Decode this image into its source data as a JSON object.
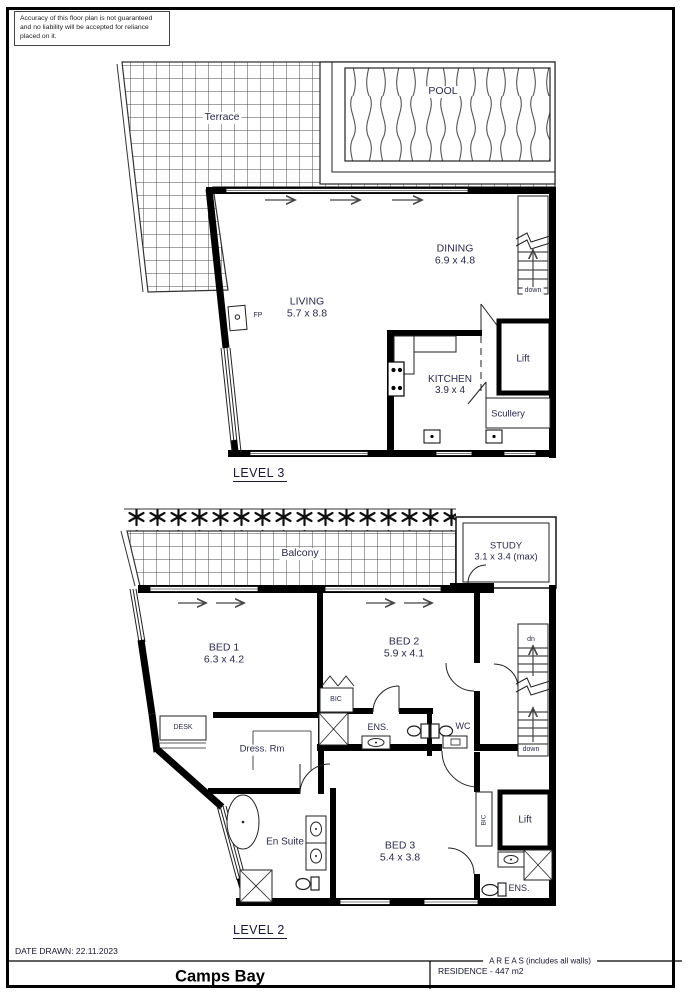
{
  "disclaimer": "Accuracy of this floor plan is not guaranteed and no liability will be accepted for reliance placed on it.",
  "l3": {
    "title": "LEVEL 3",
    "terrace": "Terrace",
    "pool": "POOL",
    "living": {
      "name": "LIVING",
      "dims": "5.7 x 8.8"
    },
    "dining": {
      "name": "DINING",
      "dims": "6.9 x 4.8"
    },
    "kitchen": {
      "name": "KITCHEN",
      "dims": "3.9 x 4"
    },
    "scullery": "Scullery",
    "lift": "Lift",
    "fp": "FP",
    "down": "down"
  },
  "l2": {
    "title": "LEVEL 2",
    "balcony": "Balcony",
    "study": {
      "name": "STUDY",
      "dims": "3.1 x 3.4 (max)"
    },
    "bed1": {
      "name": "BED 1",
      "dims": "6.3 x 4.2"
    },
    "bed2": {
      "name": "BED 2",
      "dims": "5.9 x 4.1"
    },
    "bed3": {
      "name": "BED 3",
      "dims": "5.4 x 3.8"
    },
    "bic": "BIC",
    "desk": "DESK",
    "dress": "Dress. Rm",
    "ens": "ENS.",
    "wc": "WC",
    "ensuite": "En Suite",
    "lift": "Lift",
    "bic2": "BIC",
    "ens2": "ENS.",
    "up": "up",
    "down": "down"
  },
  "footer": {
    "date": "DATE DRAWN: 22.11.2023",
    "title": "Camps Bay",
    "areas_header": "A R E A S (includes all walls)",
    "residence": "RESIDENCE - 447 m2"
  }
}
